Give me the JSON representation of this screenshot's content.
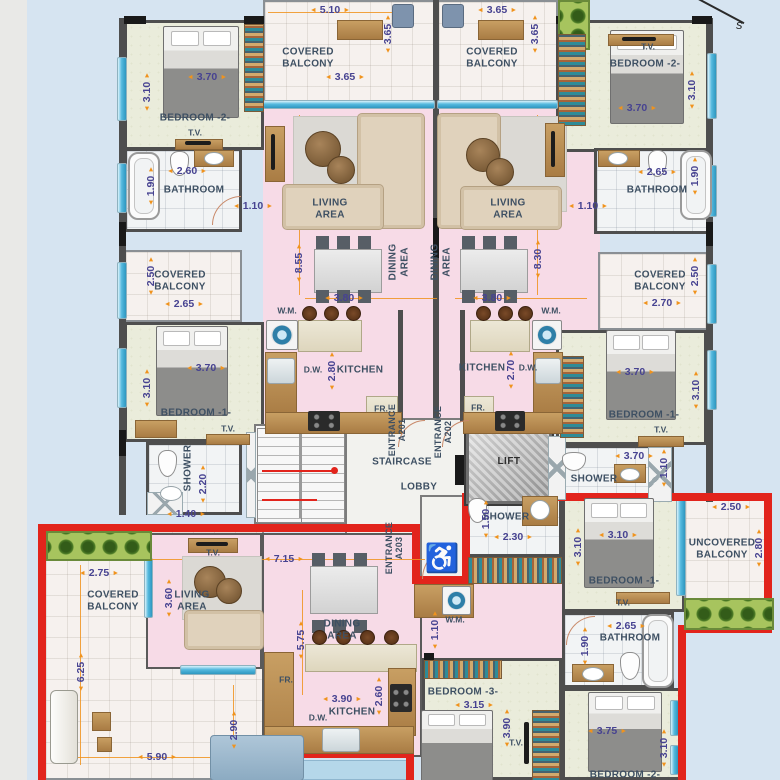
{
  "compass": {
    "label": "s"
  },
  "core": {
    "staircase": "STAIRCASE",
    "lobby": "LOBBY",
    "lift": "LIFT",
    "accessible_icon": "♿"
  },
  "unit_a201": {
    "entrance": {
      "label": "ENTRANCE",
      "unit": "A201"
    },
    "balcony_top": {
      "label": "COVERED BALCONY",
      "dim_top": "5.10",
      "dim_side": "3.65",
      "dim_w": "3.65"
    },
    "bedroom2": {
      "label": "BEDROOM -2-",
      "dim_w": "3.70",
      "dim_h": "3.10",
      "tv": "T.V."
    },
    "bathroom": {
      "label": "BATHROOM",
      "dim_w": "2.60",
      "dim_h": "1.90",
      "dim_hall": "1.10"
    },
    "living": {
      "label": "LIVING AREA",
      "dim_h": "8.55"
    },
    "dining": {
      "label": "DINING AREA",
      "dim_w": "3.80"
    },
    "kitchen": {
      "label": "KITCHEN",
      "dim_h": "2.80",
      "wm": "W.M.",
      "dw": "D.W.",
      "fr": "FR."
    },
    "balcony_mid": {
      "label": "COVERED BALCONY",
      "dim_w": "2.65",
      "dim_h": "2.50"
    },
    "bedroom1": {
      "label": "BEDROOM -1-",
      "dim_w": "3.70",
      "dim_h": "3.10",
      "tv": "T.V."
    },
    "shower": {
      "label": "SHOWER",
      "dim_h": "2.20",
      "dim_w": "1.40"
    }
  },
  "unit_a202": {
    "entrance": {
      "label": "ENTRANCE",
      "unit": "A202"
    },
    "balcony_top": {
      "label": "COVERED BALCONY",
      "dim_top": "3.65",
      "dim_side": "3.65"
    },
    "bedroom2": {
      "label": "BEDROOM -2-",
      "dim_w": "3.70",
      "dim_h": "3.10",
      "tv": "T.V."
    },
    "bathroom": {
      "label": "BATHROOM",
      "dim_w": "2.65",
      "dim_h": "1.90",
      "dim_hall": "1.10"
    },
    "living": {
      "label": "LIVING AREA",
      "dim_h": "8.30"
    },
    "dining": {
      "label": "DINING AREA",
      "dim_w": "3.80"
    },
    "kitchen": {
      "label": "KITCHEN",
      "dim_h": "2.70",
      "wm": "W.M.",
      "dw": "D.W.",
      "fr": "FR."
    },
    "balcony_mid": {
      "label": "COVERED BALCONY",
      "dim_w": "2.70",
      "dim_h": "2.50"
    },
    "bedroom1": {
      "label": "BEDROOM -1-",
      "dim_w": "3.70",
      "dim_h": "3.10",
      "tv": "T.V."
    },
    "shower": {
      "label": "SHOWER",
      "dim_w": "3.70",
      "dim_h": "1.10"
    }
  },
  "unit_a203": {
    "entrance": {
      "label": "ENTRANCE",
      "unit": "A203"
    },
    "shower": {
      "label": "SHOWER",
      "dim_h": "1.50",
      "dim_w": "2.30"
    },
    "laundry": {
      "wm": "W.M.",
      "dim": "1.10"
    },
    "balcony": {
      "label": "COVERED BALCONY",
      "dim_w": "2.75",
      "dim_h": "6.25",
      "dim_w2": "5.90",
      "dim_h2": "2.90"
    },
    "living": {
      "label": "LIVING AREA",
      "dim_h": "3.60",
      "tv": "T.V."
    },
    "dining": {
      "label": "DINING AREA",
      "dim_w": "7.15",
      "dim_h": "5.75"
    },
    "kitchen": {
      "label": "KITCHEN",
      "dim_w": "3.90",
      "dim_h": "2.60",
      "dw": "D.W.",
      "fr": "FR."
    },
    "bedroom1": {
      "label": "BEDROOM -1-",
      "dim_w": "3.10",
      "dim_h": "3.10",
      "tv": "T.V."
    },
    "uncovered_balcony": {
      "label": "UNCOVERED BALCONY",
      "dim_w": "2.50",
      "dim_h": "2.80"
    },
    "bathroom": {
      "label": "BATHROOM",
      "dim_w": "2.65",
      "dim_h": "1.90"
    },
    "bedroom3": {
      "label": "BEDROOM -3-",
      "dim_w": "3.15",
      "dim_h": "3.90",
      "tv": "T.V."
    },
    "bedroom2": {
      "label": "BEDROOM -2-",
      "dim_w": "3.75",
      "dim_h": "3.10"
    }
  },
  "colors": {
    "outline_red": "#e2241c",
    "dimension_orange": "#f0931d",
    "dimension_text": "#474391",
    "living_pink": "#f7dbe7",
    "bedroom_beige": "#eaecdb",
    "window_blue": "#55b9de"
  }
}
